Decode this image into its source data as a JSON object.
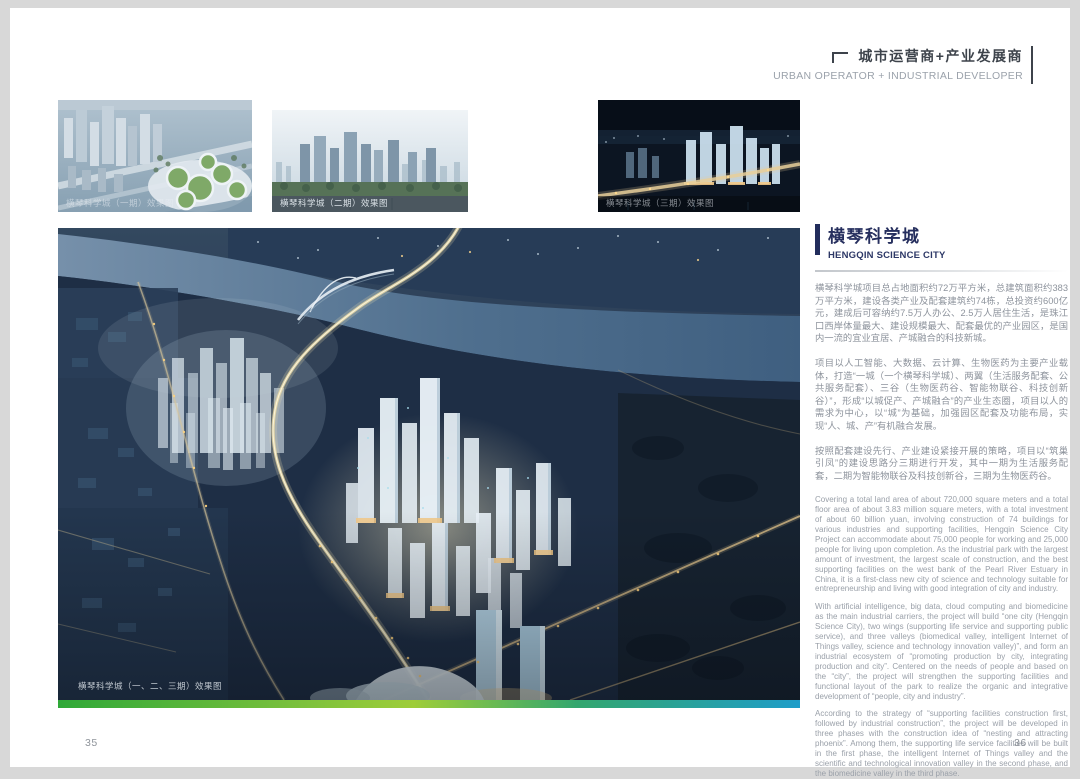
{
  "header": {
    "title_cn": "城市运营商+产业发展商",
    "title_en": "URBAN OPERATOR + INDUSTRIAL DEVELOPER",
    "bracket_icon": "corner-bracket"
  },
  "thumbnails": [
    {
      "caption": "横琴科学城（一期）效果图"
    },
    {
      "caption": "横琴科学城（二期）效果图"
    },
    {
      "caption": "横琴科学城（三期）效果图"
    }
  ],
  "main_image": {
    "caption": "横琴科学城（一、二、三期）效果图"
  },
  "article": {
    "title_cn": "横琴科学城",
    "title_en": "HENGQIN SCIENCE CITY",
    "cn": {
      "p1": "横琴科学城项目总占地面积约72万平方米，总建筑面积约383万平方米，建设各类产业及配套建筑约74栋，总投资约600亿元，建成后可容纳约7.5万人办公、2.5万人居住生活，是珠江口西岸体量最大、建设规模最大、配套最优的产业园区，是国内一流的宜业宜居、产城融合的科技新城。",
      "p2": "项目以人工智能、大数据、云计算、生物医药为主要产业载体，打造“一城（一个横琴科学城）、两翼（生活服务配套、公共服务配套）、三谷（生物医药谷、智能物联谷、科技创新谷）”，形成“以城促产、产城融合”的产业生态圈，项目以人的需求为中心，以“城”为基础，加强园区配套及功能布局，实现“人、城、产”有机融合发展。",
      "p3": "按照配套建设先行、产业建设紧接开展的策略，项目以“筑巢引凤”的建设思路分三期进行开发，其中一期为生活服务配套，二期为智能物联谷及科技创新谷，三期为生物医药谷。"
    },
    "en": {
      "p1": "Covering a total land area of about 720,000 square meters and a total floor area of about 3.83 million square meters, with a total investment of about 60 billion yuan, involving construction of 74 buildings for various industries and supporting facilities, Hengqin Science City Project can accommodate about 75,000 people for working and 25,000 people for living upon completion. As the industrial park with the largest amount of investment, the largest scale of construction, and the best supporting facilities on the west bank of the Pearl River Estuary in China, it is a first-class new city of science and technology suitable for entrepreneurship and living with good integration of city and industry.",
      "p2": "With artificial intelligence, big data, cloud computing and biomedicine as the main industrial carriers, the project will build “one city (Hengqin Science City), two wings (supporting life service and supporting public service), and three valleys (biomedical valley, intelligent Internet of Things valley, science and technology innovation valley)”, and form an industrial ecosystem of “promoting production by city, integrating production and city”. Centered on the needs of people and based on the “city”, the project will strengthen the supporting facilities and functional layout of the park to realize the organic and integrative development of “people, city and industry”.",
      "p3": "According to the strategy of “supporting facilities construction first, followed by industrial construction”, the project will be developed in three phases with the construction idea of “nesting and attracting phoenix”. Among them, the supporting life service facilities will be built in the first phase, the intelligent Internet of Things valley and the scientific and technological innovation valley in the second phase, and the biomedicine valley in the third phase."
    }
  },
  "footer": {
    "page_left": "35",
    "page_right": "36"
  },
  "colors": {
    "accent_navy": "#222d5c",
    "body_text_grey": "#8d939c",
    "strip_gradient": [
      "#2fa838",
      "#9ecd39",
      "#1f9dc9"
    ]
  }
}
